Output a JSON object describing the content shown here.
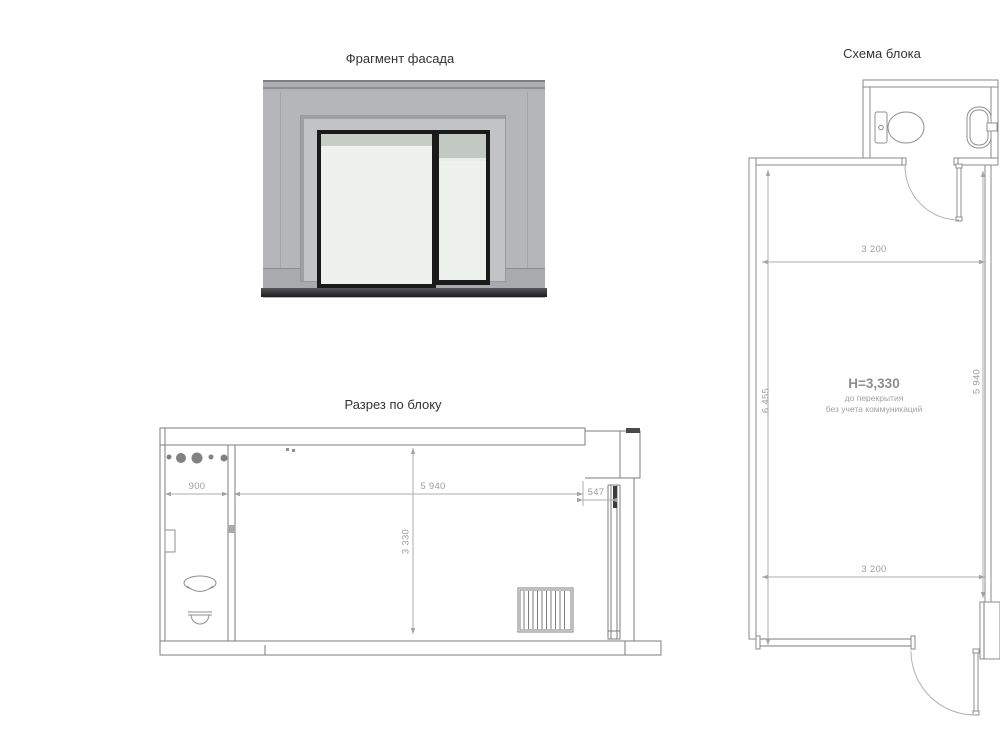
{
  "facade": {
    "title": "Фрагмент фасада"
  },
  "section": {
    "title": "Разрез по блоку",
    "dimensions": {
      "bath_width": "900",
      "room_width": "5 940",
      "room_height": "3 330",
      "parapet_width": "547"
    }
  },
  "plan": {
    "title": "Схема блока",
    "dimensions": {
      "top_width": "3 200",
      "bottom_width": "3 200",
      "left_length": "6 455",
      "right_length": "5 940"
    },
    "height_note": {
      "main": "H=3,330",
      "line2": "до перекрытия",
      "line3": "без учета коммуникаций"
    }
  },
  "colors": {
    "wall_gray": "#b5b6b9",
    "frame_black": "#1a1a1b",
    "glass": "#edf2ec",
    "line": "#7d7d7d",
    "dimension_text": "#9d9d9d"
  }
}
